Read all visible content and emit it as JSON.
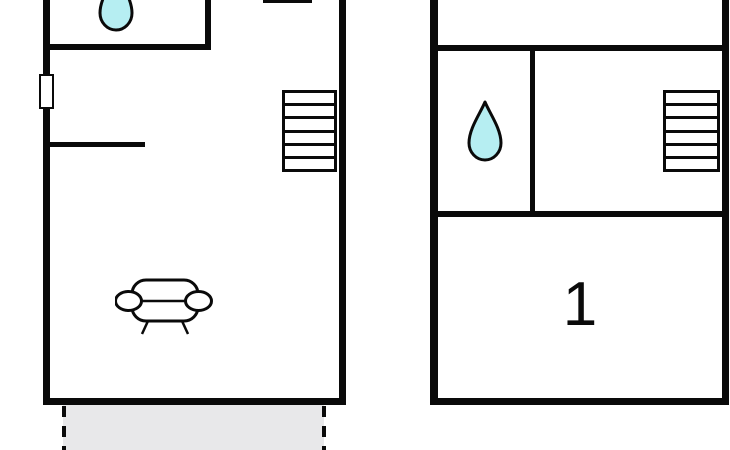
{
  "meta": {
    "type": "floor-plan",
    "units_shown": 2
  },
  "colors": {
    "wall": "#0a0a0a",
    "water_drop": "#b6eef2",
    "terrace": "#e8e8ea",
    "background": "#ffffff"
  },
  "left_unit": {
    "name": "left-unit",
    "bathroom": {
      "fixture_icon": "water-drop-icon"
    },
    "window": {
      "name": "window"
    },
    "stairs": {
      "treads": 6
    },
    "living_area": {
      "furniture_icon": "sofa-icon"
    },
    "terrace": {
      "style": "dashed-outline",
      "fill": "gray"
    }
  },
  "right_unit": {
    "name": "right-unit",
    "bathroom": {
      "fixture_icon": "water-drop-icon"
    },
    "stairs": {
      "treads": 6
    },
    "bedroom": {
      "label": "1"
    }
  }
}
